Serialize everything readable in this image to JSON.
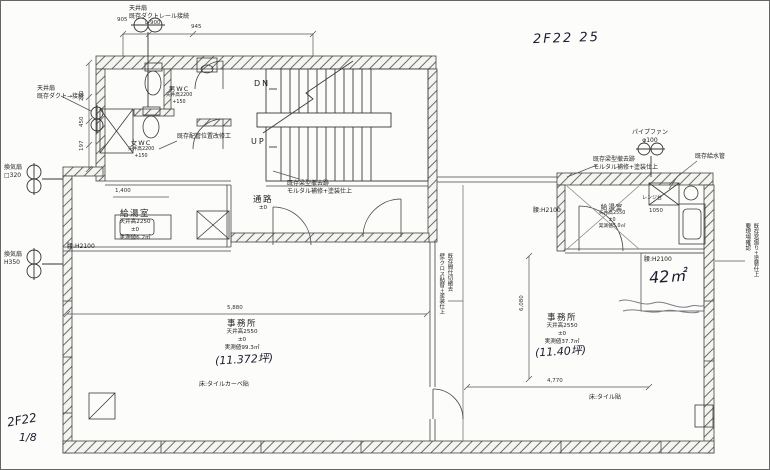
{
  "sheet": {
    "handwritten_code_top": "2F22 25",
    "handwritten_code_side": "2F22",
    "handwritten_scale": "1/8"
  },
  "stairs": {
    "down_label": "DN",
    "up_label": "UP"
  },
  "rooms": {
    "mens_wc": {
      "name": "男WC",
      "meta": "天井高2200\n+150"
    },
    "womens_wc": {
      "name": "女WC",
      "meta": "天井高2200\n+150"
    },
    "kitchenette_left": {
      "name": "給湯室",
      "meta": "天井高2250\n±0\n実測値6.2㎡"
    },
    "corridor": {
      "name": "通路",
      "meta": "±0"
    },
    "office_left": {
      "name": "事務所",
      "meta": "天井高2550\n±0\n実測値99.3㎡",
      "handwritten_area": "(11.372坪)",
      "floor_note": "床:タイルカーペ貼"
    },
    "office_right": {
      "name": "事務所",
      "meta": "天井高2550\n±0\n実測値37.7㎡",
      "handwritten_area": "(11.40坪)",
      "floor_note": "床:タイル貼"
    },
    "kitchenette_right": {
      "name": "給湯室",
      "meta": "天井高2550\n±0\n実測値5.0㎡"
    }
  },
  "annotations": {
    "ceiling_fan_duct": "天井扇\n既存ダクトレール接続",
    "ceiling_fan_grill": "天井扇\n既存ダクト→接続",
    "vent_fan_1": "換気扇\n□320",
    "vent_fan_2": "換気扇\nH350",
    "pipe_repair": "既存配管位置改修工",
    "beam_removal": "既存梁型撤去跡\nモルタル補修+塗装仕上",
    "partition_removal": "既存間仕切撤去\n壁:クロス貼替+塗装仕上",
    "pipe_fan": "パイプファン\nφ100",
    "water_pipe": "既存給水管",
    "range_stand": "レンジ台",
    "waist_wall": "腰:H2100",
    "right_side_note": "既存窓廻り+塗装仕上\n要現場確認",
    "handwritten_total_area": "42㎡"
  },
  "dimensions": {
    "top_1": "905",
    "top_2": "L-900",
    "top_3": "945",
    "left_1": "280",
    "left_2": "450",
    "left_3": "197",
    "kitchenette_width": "1,400",
    "office_left_width": "5,880",
    "office_right_width": "4,770",
    "office_right_height": "6,080",
    "range_width": "1050"
  }
}
